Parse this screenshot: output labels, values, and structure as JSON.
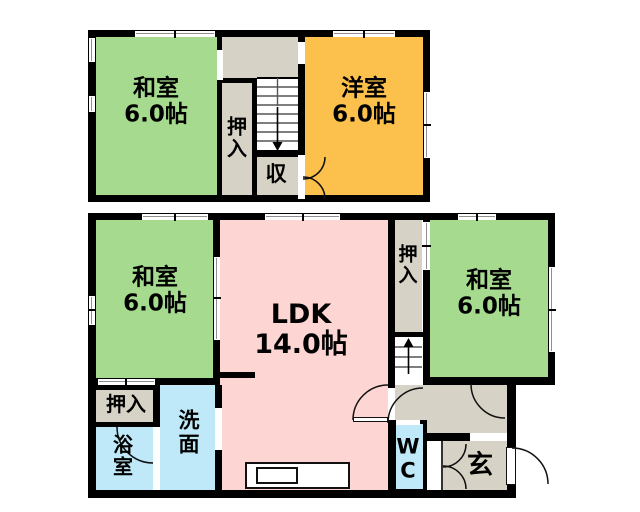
{
  "meta": {
    "title": "Floor plan (madori-zu)",
    "canvas_w": 640,
    "canvas_h": 512
  },
  "palette": {
    "tatami_green": "#a6da8e",
    "western_orange": "#fcc04c",
    "ldk_pink": "#fdd6d4",
    "hall_gray": "#d6d2c5",
    "wet_cyan": "#bfe9f8",
    "wall": "#000000",
    "bg": "#ffffff",
    "step_line": "#555555",
    "arc_line": "#111111"
  },
  "floors": [
    {
      "id": "2f",
      "rooms": [
        {
          "id": "washitsu-2f",
          "fill": "tatami_green",
          "x": 96,
          "y": 37,
          "w": 121,
          "h": 158
        },
        {
          "id": "hall-2f",
          "fill": "hall_gray",
          "x": 222,
          "y": 37,
          "w": 76,
          "h": 41
        },
        {
          "id": "oshiire-2f",
          "fill": "hall_gray",
          "x": 222,
          "y": 83,
          "w": 30,
          "h": 112
        },
        {
          "id": "stairs-2f-area",
          "fill": "bg",
          "x": 257,
          "y": 78,
          "w": 41,
          "h": 72
        },
        {
          "id": "shuunou-2f",
          "fill": "hall_gray",
          "x": 257,
          "y": 157,
          "w": 41,
          "h": 38
        },
        {
          "id": "youshitsu-2f",
          "fill": "western_orange",
          "x": 305,
          "y": 37,
          "w": 118,
          "h": 158
        }
      ],
      "walls": [
        {
          "x": 88,
          "y": 30,
          "w": 342,
          "h": 7
        },
        {
          "x": 88,
          "y": 195,
          "w": 342,
          "h": 7
        },
        {
          "x": 88,
          "y": 30,
          "w": 8,
          "h": 172
        },
        {
          "x": 423,
          "y": 30,
          "w": 7,
          "h": 172
        },
        {
          "x": 217,
          "y": 37,
          "w": 5,
          "h": 158
        },
        {
          "x": 298,
          "y": 37,
          "w": 7,
          "h": 158
        },
        {
          "x": 222,
          "y": 78,
          "w": 35,
          "h": 5
        },
        {
          "x": 252,
          "y": 83,
          "w": 5,
          "h": 112
        },
        {
          "x": 257,
          "y": 150,
          "w": 46,
          "h": 7
        },
        {
          "x": 257,
          "y": 77,
          "w": 41,
          "h": 1.5
        }
      ],
      "windows": [
        {
          "x": 135,
          "y": 30.5,
          "w": 80,
          "h": 6,
          "dir": "h",
          "ticks": [
            175
          ]
        },
        {
          "x": 333,
          "y": 30.5,
          "w": 62,
          "h": 6,
          "dir": "h",
          "ticks": [
            364
          ]
        },
        {
          "x": 88.5,
          "y": 38,
          "w": 6.5,
          "h": 24,
          "dir": "v",
          "ticks": []
        },
        {
          "x": 88.5,
          "y": 96,
          "w": 6.5,
          "h": 16,
          "dir": "v",
          "ticks": []
        },
        {
          "x": 423.5,
          "y": 92,
          "w": 6,
          "h": 66,
          "dir": "v",
          "ticks": [
            125
          ]
        }
      ],
      "openings": [
        {
          "x": 216.5,
          "y": 50,
          "w": 6,
          "h": 30,
          "dir": "v",
          "ticks": []
        },
        {
          "x": 297.5,
          "y": 42,
          "w": 7.5,
          "h": 22,
          "dir": "v",
          "ticks": []
        },
        {
          "x": 297.5,
          "y": 155,
          "w": 7.5,
          "h": 44,
          "dir": "v",
          "ticks": []
        }
      ],
      "arcs": [
        {
          "id": "shuunou-door-top",
          "d": "M325 157 A22 22 0 0 1 303 179"
        },
        {
          "id": "shuunou-door-bottom",
          "d": "M325 199 A22 22 0 0 0 303 177"
        }
      ],
      "stairs": {
        "x": 257,
        "y": 78,
        "w": 41,
        "h": 72,
        "steps_y": [
          87,
          96,
          105,
          114,
          123,
          132,
          141
        ],
        "divider": {
          "x": 277.5,
          "y1": 78,
          "y2": 106
        },
        "arrow": {
          "x": 277.5,
          "from": 107,
          "to": 142,
          "dir": "down"
        }
      },
      "labels": [
        {
          "id": "washitsu-2f-label",
          "lines": [
            "和室",
            "6.0帖"
          ],
          "x": 156,
          "y": 102,
          "size": 23
        },
        {
          "id": "oshiire-2f-label",
          "lines": [
            "押",
            "入"
          ],
          "x": 237,
          "y": 138,
          "size": 20
        },
        {
          "id": "shuunou-label",
          "lines": [
            "収"
          ],
          "x": 276,
          "y": 175,
          "size": 21
        },
        {
          "id": "youshitsu-label",
          "lines": [
            "洋室",
            "6.0帖"
          ],
          "x": 364,
          "y": 102,
          "size": 23
        }
      ]
    },
    {
      "id": "1f",
      "rooms": [
        {
          "id": "washitsu-1f-west",
          "fill": "tatami_green",
          "x": 96,
          "y": 220,
          "w": 117,
          "h": 158
        },
        {
          "id": "ldk",
          "fill": "ldk_pink",
          "x": 220,
          "y": 220,
          "w": 168,
          "h": 270
        },
        {
          "id": "oshiire-1f-mid",
          "fill": "hall_gray",
          "x": 395,
          "y": 220,
          "w": 27,
          "h": 112
        },
        {
          "id": "stairs-1f-area",
          "fill": "bg",
          "x": 395,
          "y": 337,
          "w": 27,
          "h": 48
        },
        {
          "id": "washitsu-1f-east",
          "fill": "tatami_green",
          "x": 430,
          "y": 220,
          "w": 118,
          "h": 157
        },
        {
          "id": "hall-1f",
          "fill": "hall_gray",
          "x": 395,
          "y": 385,
          "w": 112,
          "h": 49
        },
        {
          "id": "wc",
          "fill": "wet_cyan",
          "x": 396,
          "y": 424,
          "w": 27,
          "h": 65
        },
        {
          "id": "entry-step",
          "fill": "bg",
          "x": 427,
          "y": 441,
          "w": 14,
          "h": 49
        },
        {
          "id": "genkan",
          "fill": "hall_gray",
          "x": 443,
          "y": 441,
          "w": 64,
          "h": 49
        },
        {
          "id": "senmen",
          "fill": "wet_cyan",
          "x": 160,
          "y": 385,
          "w": 55,
          "h": 105
        },
        {
          "id": "yokushitsu",
          "fill": "wet_cyan",
          "x": 96,
          "y": 427,
          "w": 57,
          "h": 63
        },
        {
          "id": "oshiire-1f-sw",
          "fill": "hall_gray",
          "x": 96,
          "y": 390,
          "w": 57,
          "h": 32
        }
      ],
      "walls": [
        {
          "x": 88,
          "y": 213,
          "w": 467,
          "h": 7
        },
        {
          "x": 88,
          "y": 213,
          "w": 8,
          "h": 285
        },
        {
          "x": 88,
          "y": 490,
          "w": 428,
          "h": 8
        },
        {
          "x": 548,
          "y": 213,
          "w": 7,
          "h": 172
        },
        {
          "x": 423,
          "y": 377,
          "w": 132,
          "h": 8
        },
        {
          "x": 507,
          "y": 377,
          "w": 9,
          "h": 121
        },
        {
          "x": 213,
          "y": 220,
          "w": 7,
          "h": 165
        },
        {
          "x": 88,
          "y": 378,
          "w": 132,
          "h": 7
        },
        {
          "x": 93,
          "y": 385,
          "w": 67,
          "h": 5
        },
        {
          "x": 153,
          "y": 385,
          "w": 7,
          "h": 42
        },
        {
          "x": 93,
          "y": 422,
          "w": 67,
          "h": 5
        },
        {
          "x": 215,
          "y": 385,
          "w": 7,
          "h": 105
        },
        {
          "x": 388,
          "y": 220,
          "w": 7,
          "h": 270
        },
        {
          "x": 392,
          "y": 332,
          "w": 38,
          "h": 5
        },
        {
          "x": 423,
          "y": 213,
          "w": 7,
          "h": 164
        },
        {
          "x": 427,
          "y": 433,
          "w": 43,
          "h": 8
        },
        {
          "x": 392,
          "y": 420,
          "w": 35,
          "h": 4
        },
        {
          "x": 392,
          "y": 420,
          "w": 4,
          "h": 73
        },
        {
          "x": 423,
          "y": 420,
          "w": 4,
          "h": 73
        },
        {
          "x": 392,
          "y": 489,
          "w": 35,
          "h": 4
        },
        {
          "x": 218,
          "y": 372,
          "w": 37,
          "h": 6
        }
      ],
      "windows": [
        {
          "x": 142,
          "y": 213.5,
          "w": 66,
          "h": 6,
          "dir": "h",
          "ticks": [
            175
          ]
        },
        {
          "x": 265,
          "y": 213.5,
          "w": 75,
          "h": 6,
          "dir": "h",
          "ticks": [
            303
          ]
        },
        {
          "x": 458,
          "y": 213.5,
          "w": 38,
          "h": 6,
          "dir": "h",
          "ticks": [
            477
          ]
        },
        {
          "x": 88.5,
          "y": 296,
          "w": 6.5,
          "h": 29,
          "dir": "v",
          "ticks": [
            310
          ]
        },
        {
          "x": 548.5,
          "y": 267,
          "w": 6,
          "h": 85,
          "dir": "v",
          "ticks": [
            310
          ]
        }
      ],
      "openings": [
        {
          "x": 213.5,
          "y": 257,
          "w": 6.5,
          "h": 83,
          "dir": "v",
          "ticks": [
            298
          ]
        },
        {
          "x": 98,
          "y": 378.5,
          "w": 57,
          "h": 6,
          "dir": "h",
          "ticks": [
            126
          ]
        },
        {
          "x": 423,
          "y": 222,
          "w": 7,
          "h": 48,
          "dir": "v",
          "ticks": [
            246
          ]
        },
        {
          "x": 215,
          "y": 408,
          "w": 7,
          "h": 42,
          "dir": "v",
          "ticks": []
        },
        {
          "x": 388,
          "y": 388,
          "w": 7,
          "h": 32,
          "dir": "v",
          "ticks": []
        },
        {
          "x": 396,
          "y": 419.5,
          "w": 24,
          "h": 5,
          "dir": "h",
          "ticks": []
        },
        {
          "x": 470,
          "y": 433,
          "w": 37,
          "h": 8,
          "dir": "h",
          "ticks": []
        },
        {
          "x": 507,
          "y": 447,
          "w": 9,
          "h": 38,
          "dir": "v",
          "ticks": []
        }
      ],
      "arcs": [
        {
          "id": "ldk-door",
          "d": "M353 420 A35 35 0 0 1 388 385"
        },
        {
          "id": "wc-door",
          "d": "M423 388 A35 35 0 0 0 388 423"
        },
        {
          "id": "washitsu-east-door",
          "d": "M471 384 A34 34 0 0 0 505 418"
        },
        {
          "id": "bath-door",
          "d": "M117 427 A36 36 0 0 0 153 463"
        },
        {
          "id": "genkan-cabinet-top",
          "d": "M466 444 A23 23 0 0 1 443 467"
        },
        {
          "id": "genkan-cabinet-bottom",
          "d": "M466 489 A23 23 0 0 0 443 466"
        },
        {
          "id": "entrance-door",
          "d": "M512 448 A36 36 0 0 1 548 484"
        }
      ],
      "stairs": {
        "x": 395,
        "y": 337,
        "w": 27,
        "h": 48,
        "steps_y": [
          347,
          357,
          367
        ],
        "arrow": {
          "x": 408.5,
          "from": 374,
          "to": 347,
          "dir": "up"
        }
      },
      "labels": [
        {
          "id": "washitsu-1f-west-label",
          "lines": [
            "和室",
            "6.0帖"
          ],
          "x": 155,
          "y": 291,
          "size": 23
        },
        {
          "id": "ldk-label",
          "lines": [
            "LDK",
            "14.0帖"
          ],
          "x": 301,
          "y": 330,
          "size": 27
        },
        {
          "id": "oshiire-1f-mid-label",
          "lines": [
            "押",
            "入"
          ],
          "x": 408,
          "y": 266,
          "size": 19
        },
        {
          "id": "washitsu-1f-east-label",
          "lines": [
            "和室",
            "6.0帖"
          ],
          "x": 489,
          "y": 294,
          "size": 23
        },
        {
          "id": "oshiire-1f-sw-label",
          "lines": [
            "押入"
          ],
          "x": 126,
          "y": 404,
          "size": 20
        },
        {
          "id": "yokushitsu-label",
          "lines": [
            "浴",
            "室"
          ],
          "x": 123,
          "y": 456,
          "size": 20
        },
        {
          "id": "senmen-label",
          "lines": [
            "洗",
            "面"
          ],
          "x": 189,
          "y": 433,
          "size": 21
        },
        {
          "id": "wc-label",
          "lines": [
            "W",
            "C"
          ],
          "x": 408,
          "y": 459,
          "size": 21
        },
        {
          "id": "genkan-label",
          "lines": [
            "玄"
          ],
          "x": 480,
          "y": 466,
          "size": 26
        }
      ]
    }
  ],
  "fixtures": {
    "kitchen_counter": {
      "x": 245,
      "y": 462,
      "w": 105,
      "h": 27
    },
    "kitchen_sink": {
      "x": 256,
      "y": 467,
      "w": 42,
      "h": 17
    },
    "entrance_door_leaf": {
      "x": 505.5,
      "y": 447,
      "w": 10,
      "h": 38
    },
    "ldk_door_leaf": {
      "x": 353,
      "y": 416.5,
      "w": 35,
      "h": 5
    },
    "agarikamachi_step_edge": {
      "x": 441,
      "y": 441,
      "w": 2,
      "h": 49
    }
  }
}
